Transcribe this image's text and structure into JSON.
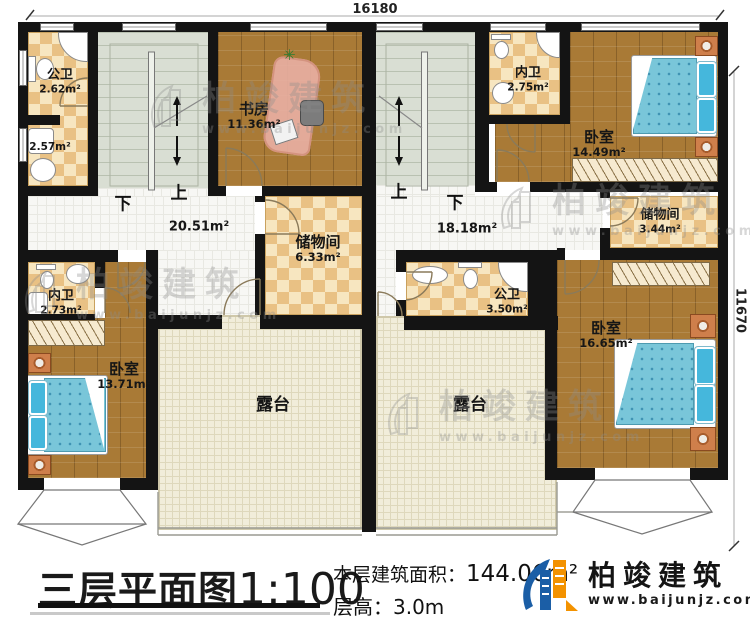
{
  "plan": {
    "dimensions": {
      "width": "16180",
      "height": "11670"
    },
    "stairs": {
      "left": {
        "down": "下",
        "up": "上"
      },
      "right": {
        "up": "上",
        "down": "下"
      }
    },
    "rooms": {
      "bath_nw": {
        "name": "公卫",
        "area": "2.62m²"
      },
      "laundry": {
        "area": "2.57m²"
      },
      "study": {
        "name": "书房",
        "area": "11.36m²"
      },
      "bath_n": {
        "name": "内卫",
        "area": "2.75m²"
      },
      "bedroom_ne": {
        "name": "卧室",
        "area": "14.49m²"
      },
      "storage_e": {
        "name": "储物间",
        "area": "3.44m²"
      },
      "storage_c": {
        "name": "储物间",
        "area": "6.33m²"
      },
      "hall_w": {
        "area": "20.51m²"
      },
      "hall_e": {
        "area": "18.18m²"
      },
      "bath_w": {
        "name": "内卫",
        "area": "2.73m²"
      },
      "bath_c": {
        "name": "公卫",
        "area": "3.50m²"
      },
      "bedroom_sw": {
        "name": "卧室",
        "area": "13.71m²"
      },
      "bedroom_se": {
        "name": "卧室",
        "area": "16.65m²"
      },
      "terrace_w": {
        "name": "露台"
      },
      "terrace_e": {
        "name": "露台"
      }
    }
  },
  "title_block": {
    "title": "三层平面图",
    "scale": "1:100",
    "area_label": "本层建筑面积：",
    "area_value": "144.06m²",
    "height_label": "层高：",
    "height_value": "3.0m"
  },
  "brand": {
    "name": "柏竣建筑",
    "url": "www.baijunjz.com"
  },
  "colors": {
    "wall": "#141414",
    "wood": "#a97a36",
    "checker_dark": "#e9c184",
    "checker_light": "#f7e6c0",
    "stair": "#d9ded3",
    "terrace": "#f1edda",
    "bed": "#79c6d9",
    "brand_blue": "#1b5ea6",
    "brand_orange": "#f39200"
  }
}
